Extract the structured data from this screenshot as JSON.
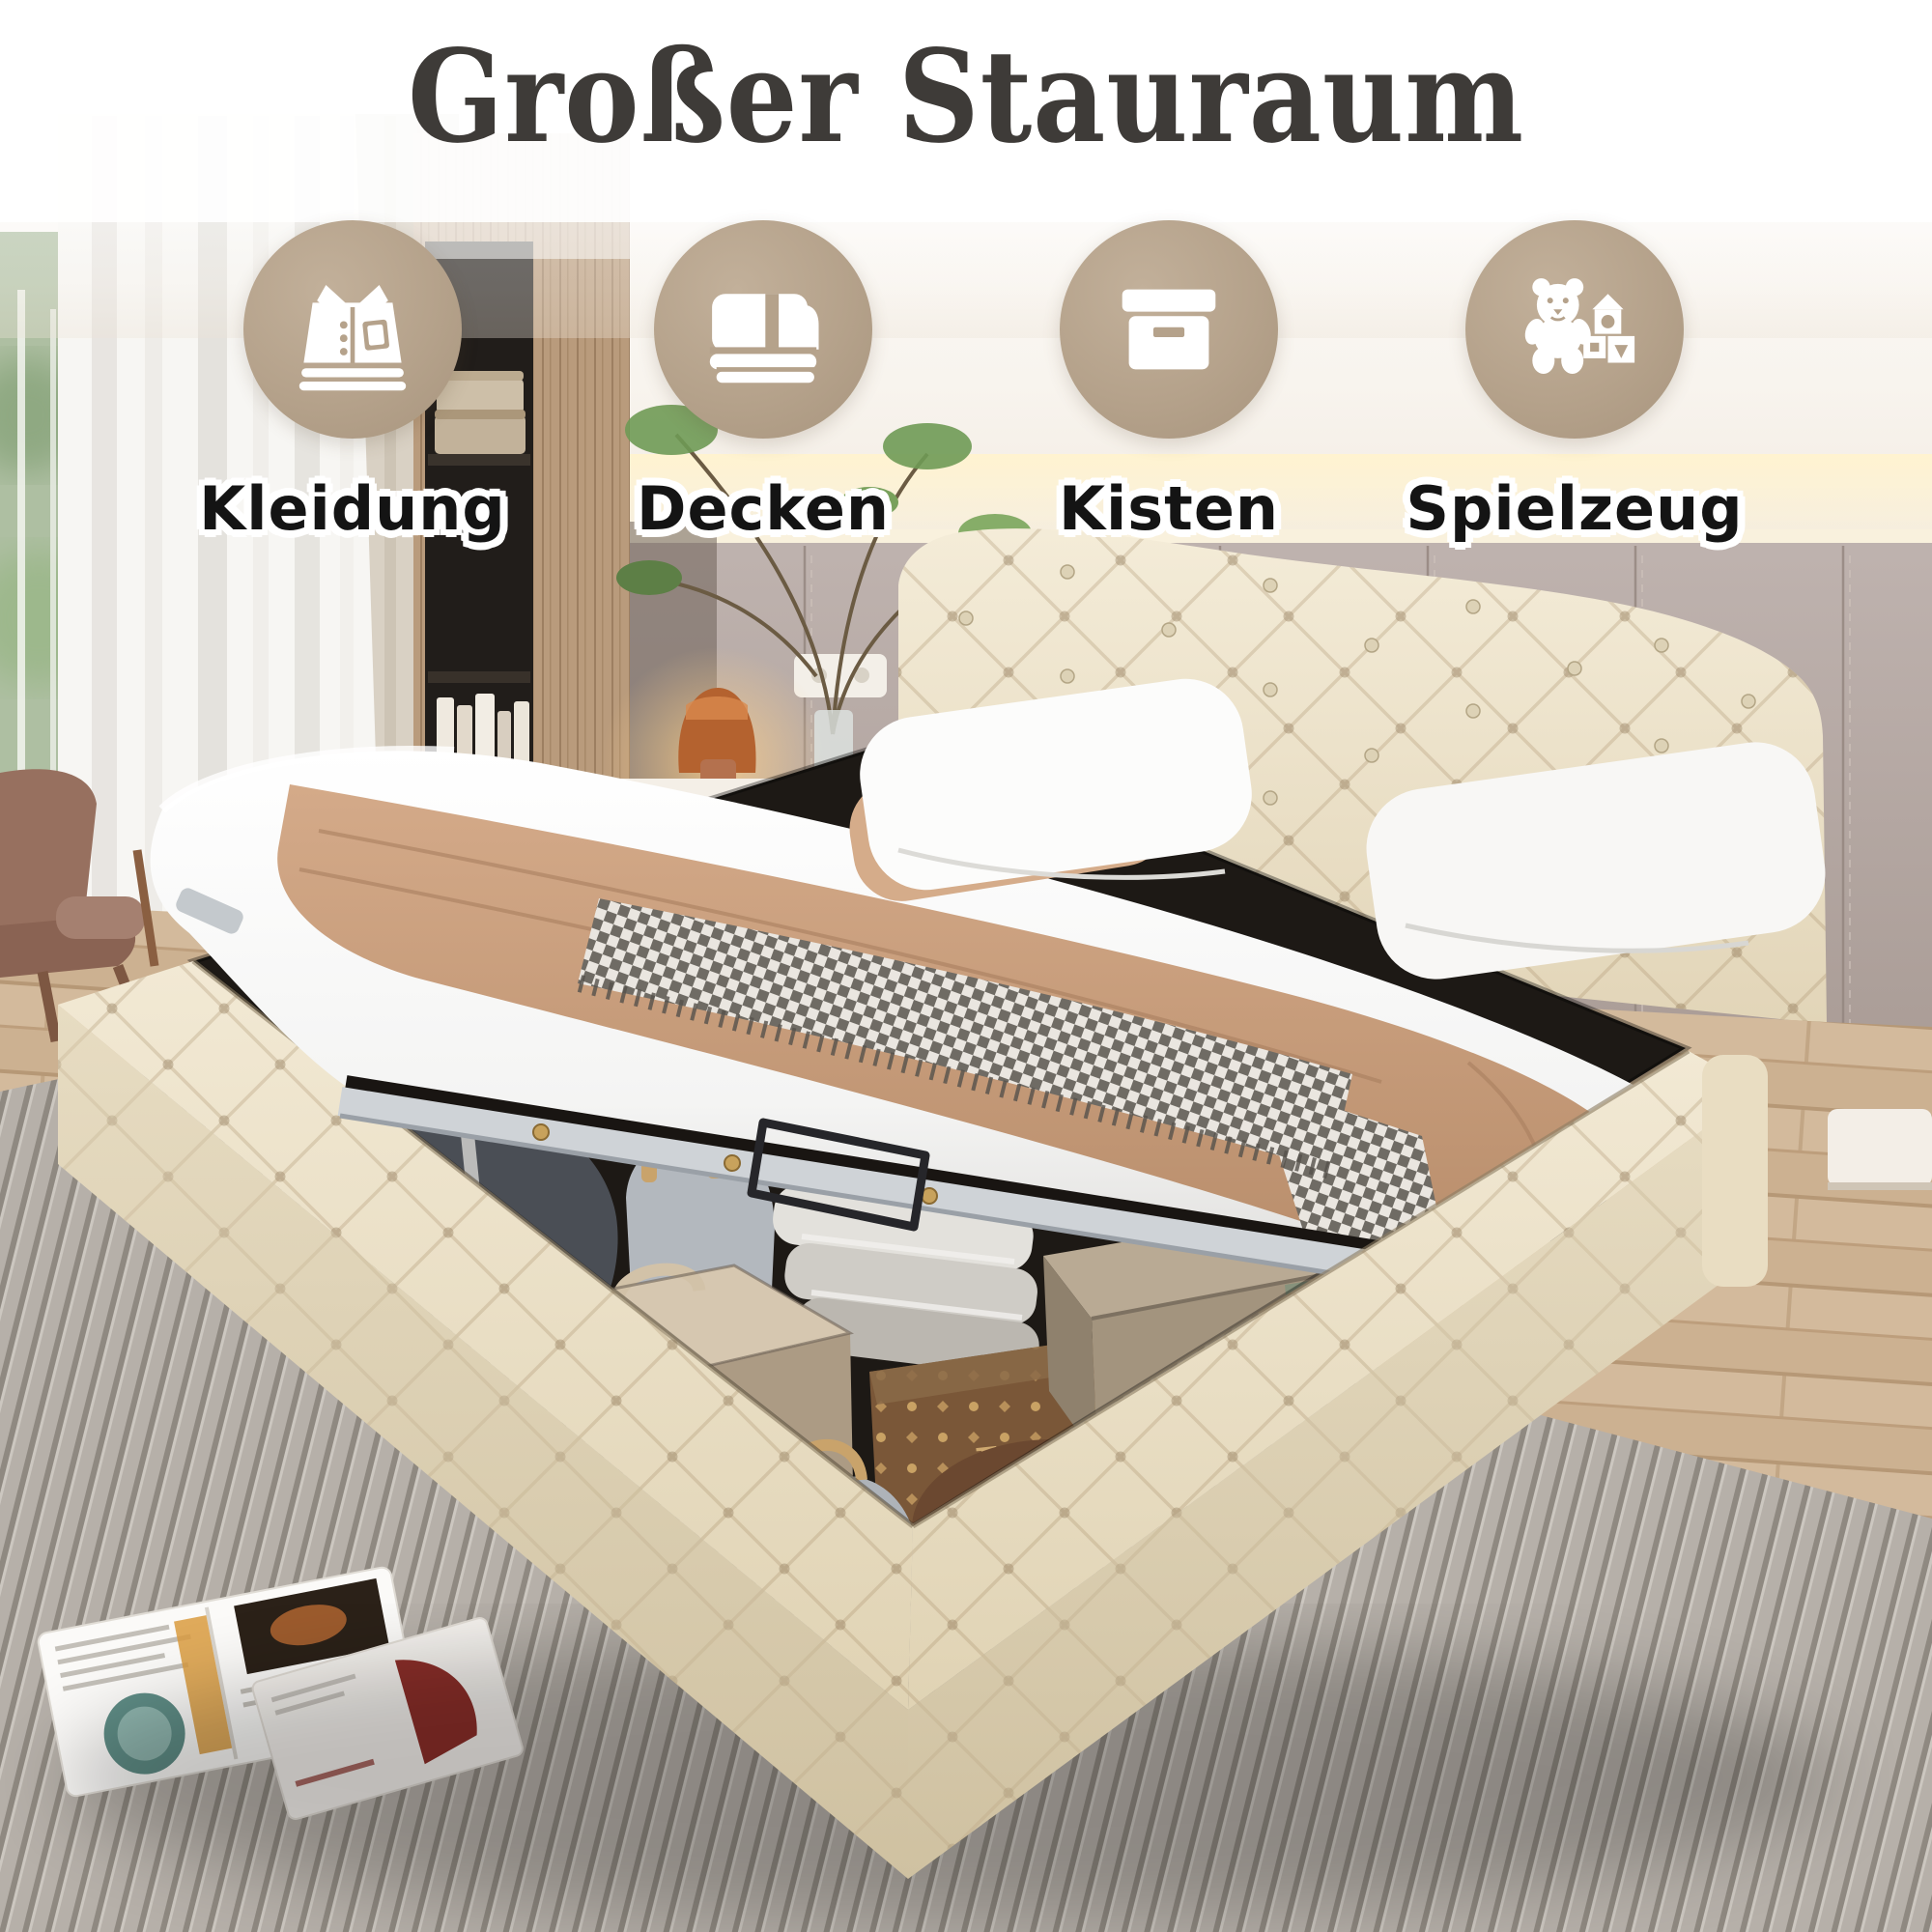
{
  "title": "Großer Stauraum",
  "features": [
    {
      "label": "Kleidung",
      "icon": "clothing-icon"
    },
    {
      "label": "Decken",
      "icon": "blanket-icon"
    },
    {
      "label": "Kisten",
      "icon": "storage-box-icon"
    },
    {
      "label": "Spielzeug",
      "icon": "teddy-bear-icon"
    }
  ],
  "scene": {
    "lv_monogram": "LV",
    "lv_brand": "VUITTON"
  },
  "colors": {
    "badge": "#b5a28b",
    "title_text": "#3e3b38",
    "label_text": "#141414",
    "label_outline": "#ffffff",
    "velvet": "#efe5cd",
    "wall_panel": "#b2a5a1",
    "blanket_tan": "#c89e7d",
    "rug_gray": "#b5afa8",
    "wood_floor": "#ccb191",
    "storage_dark": "#1d1915"
  }
}
